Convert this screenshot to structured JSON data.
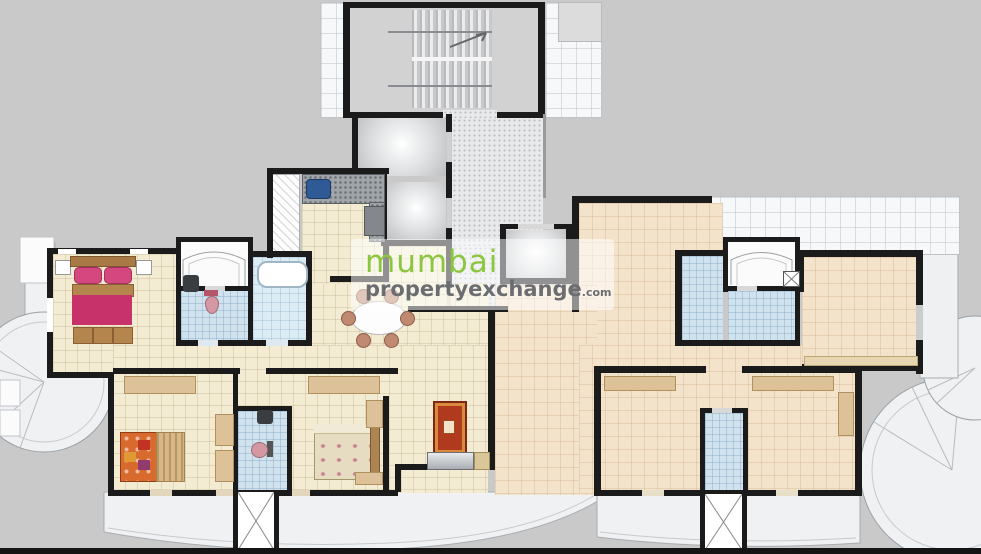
{
  "watermark": {
    "logo_icon": "orange-bracket-frame-icon",
    "text_primary": "mumbai",
    "text_secondary": "propertyexchange",
    "text_suffix": ".com",
    "color_primary": "#8cc63f",
    "color_secondary": "#6b6d70",
    "color_logo": "#e8802d"
  },
  "palette": {
    "background": "#c9c9c9",
    "wall": "#1b1b1b",
    "left_flat_floor": "#f3ecd3",
    "right_flat_floor": "#f4e3cb",
    "bathroom_floor": "#cfe2ee",
    "bathroom_floor_light": "#dcecf5",
    "lobby_floor": "#e7e9eb",
    "stair_floor": "#d2d2d2",
    "balcony_floor": "#f0f1f3",
    "terrace_floor": "#f7f8f9",
    "bed_master_linen": "#c7326b",
    "bed_wood": "#b5854e",
    "bed_patchwork": "#d96a2e",
    "rug": "#b03a1e",
    "counter_granite": "#9fa5a9",
    "sink": "#2f5a96"
  },
  "plan": {
    "type": "residential-floor-plan",
    "flats": 2,
    "features": [
      "staircase",
      "lift-lobby",
      "lift",
      "lift",
      "lift",
      "kitchen",
      "master-bedroom",
      "bedroom",
      "bedroom",
      "bedroom",
      "toilet",
      "bathroom",
      "toilet",
      "bathroom",
      "bathroom",
      "bathroom",
      "living-dining",
      "entrance-foyer-arch",
      "entrance-foyer-arch",
      "balcony-left-round",
      "balcony-bottom",
      "balcony-bottom-right",
      "balcony-right-round",
      "terrace"
    ]
  }
}
